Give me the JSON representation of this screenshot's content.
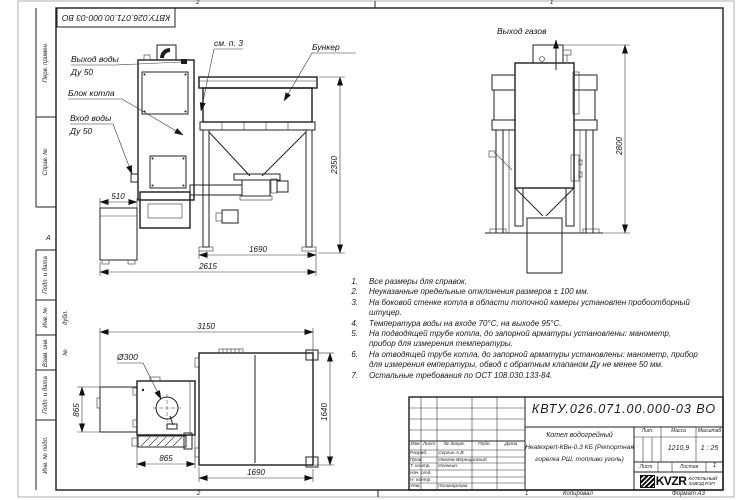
{
  "sheet": {
    "doc_number_top": "КВТУ.026.071.00.000-03 ВО",
    "zones": {
      "top_left": "2",
      "top_right": "1",
      "bottom_left": "2",
      "bottom_right": "1",
      "row_letter": "А"
    },
    "footer": {
      "copied_label": "Копировал",
      "format_label": "Формат А3"
    },
    "margin_fields": [
      "Перв. примен.",
      "Справ. №",
      "Подп. и дата",
      "Инв. № дубл.",
      "Взам. инв. №",
      "Подп. и дата",
      "Инв. № подл."
    ]
  },
  "callouts": {
    "water_out_1": "Выход воды",
    "water_out_2": "Ду 50",
    "boiler_block": "Блок котла",
    "water_in_1": "Вход воды",
    "water_in_2": "Ду 50",
    "see_note": "см. п. 3",
    "hopper": "Бункер",
    "gas_out": "Выход газов"
  },
  "dims": {
    "front": {
      "ash_width": "510",
      "hopper_width": "1690",
      "total_width": "2615",
      "height": "2350"
    },
    "side": {
      "height": "2800"
    },
    "plan": {
      "total_width": "3150",
      "flue_dia": "Ø300",
      "ash_depth": "865",
      "boiler_width": "865",
      "hopper_depth": "1640",
      "hopper_width": "1690"
    }
  },
  "notes": {
    "items": [
      {
        "num": "1.",
        "text": "Все размеры для справок."
      },
      {
        "num": "2.",
        "text": "Неуказанные предельные отклонения размеров ± 100 мм."
      },
      {
        "num": "3.",
        "text": "На боковой стенке котла в области топочной камеры установлен пробоотборный штуцер."
      },
      {
        "num": "4.",
        "text": "Температура воды на входе 70°С, на выходе 95°С."
      },
      {
        "num": "5.",
        "text": "На подводящей трубе котла, до запорной арматуры установлены: манометр, прибор для измерения температуры."
      },
      {
        "num": "6.",
        "text": "На отводящей трубе котла, до запорной арматуры установлены: манометр, прибор для измерения емпературы, обвод с обратным клапаном Ду не менее 50 мм."
      },
      {
        "num": "7.",
        "text": "Остальные требования по ОСТ 108.030.133-84."
      }
    ]
  },
  "title_block": {
    "doc_number": "КВТУ.026.071.00.000-03 ВО",
    "header": [
      "Изм",
      "Лист",
      "№ докум.",
      "Подп.",
      "Дата"
    ],
    "rows": [
      {
        "role": "Разраб.",
        "name": "Сергин А.В."
      },
      {
        "role": "Пров.",
        "name": "Онегов-Верещинский"
      },
      {
        "role": "Т. контр.",
        "name": "Осенкин"
      },
      {
        "role": "Нач. отд.",
        "name": ""
      },
      {
        "role": "Н. контр.",
        "name": ""
      },
      {
        "role": "Утв.",
        "name": "Поликарпова"
      }
    ],
    "product": {
      "line1": "Котел водогрейный",
      "line2": "Heatexpert-КВн-0,3 КБ (Ретортная",
      "line3": "горелка РШ, топливо уголь)"
    },
    "lit_label": "Лит.",
    "mass_label": "Масса",
    "scale_label": "Масштаб",
    "mass": "1210,9",
    "scale": "1 : 25",
    "sheet_label": "Лист",
    "sheets_label": "Листов",
    "sheets_value": "1"
  },
  "logo": {
    "brand": "KVZR",
    "org_line1": "КОТЕЛЬНЫЙ",
    "org_line2": "ЗАВОД РЭП"
  },
  "watermark": {
    "text": "KVZR.RU"
  }
}
